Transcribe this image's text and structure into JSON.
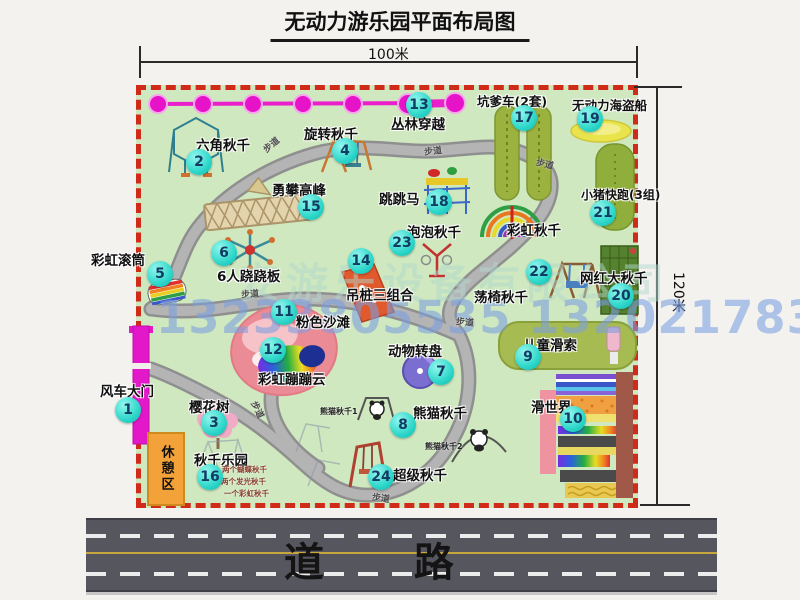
{
  "title": "无动力游乐园平面布局图",
  "dimensions": {
    "width": "100米",
    "height": "120米"
  },
  "road_label": "道 路",
  "rest_area_label": "休憩区",
  "walkway_text": "步道",
  "watermark": {
    "company": "安游乐设备有限公司",
    "phone": "13233805535 13202178333"
  },
  "colors": {
    "park_green": "#cfe8bf",
    "border_red": "#d02b18",
    "badge_cyan": "#2bd6c9",
    "gate_magenta": "#e318c8",
    "rest_orange": "#f2a238",
    "road_gray": "#56565e",
    "path_gray": "#a8a8a8"
  },
  "attractions": [
    {
      "num": "1",
      "label": "风车大门",
      "cx": 128,
      "cy": 410,
      "lx": 100,
      "ly": 380
    },
    {
      "num": "2",
      "label": "六角秋千",
      "cx": 199,
      "cy": 162,
      "lx": 196,
      "ly": 134
    },
    {
      "num": "3",
      "label": "樱花树",
      "cx": 214,
      "cy": 423,
      "lx": 189,
      "ly": 396
    },
    {
      "num": "4",
      "label": "旋转秋千",
      "cx": 345,
      "cy": 151,
      "lx": 304,
      "ly": 123
    },
    {
      "num": "5",
      "label": "彩虹滚筒",
      "cx": 160,
      "cy": 274,
      "lx": 91,
      "ly": 249
    },
    {
      "num": "6",
      "label": "6人跷跷板",
      "cx": 224,
      "cy": 253,
      "lx": 217,
      "ly": 265
    },
    {
      "num": "7",
      "label": "动物转盘",
      "cx": 441,
      "cy": 372,
      "lx": 388,
      "ly": 340
    },
    {
      "num": "8",
      "label": "熊猫秋千",
      "cx": 403,
      "cy": 425,
      "lx": 413,
      "ly": 402
    },
    {
      "num": "9",
      "label": "儿童滑索",
      "cx": 528,
      "cy": 357,
      "lx": 523,
      "ly": 334
    },
    {
      "num": "10",
      "label": "滑世界",
      "cx": 573,
      "cy": 419,
      "lx": 531,
      "ly": 396
    },
    {
      "num": "11",
      "label": "粉色沙滩",
      "cx": 284,
      "cy": 312,
      "lx": 296,
      "ly": 311
    },
    {
      "num": "12",
      "label": "彩虹蹦蹦云",
      "cx": 273,
      "cy": 350,
      "lx": 258,
      "ly": 368
    },
    {
      "num": "13",
      "label": "丛林穿越",
      "cx": 419,
      "cy": 105,
      "lx": 391,
      "ly": 113
    },
    {
      "num": "14",
      "label": "吊桩三组合",
      "cx": 361,
      "cy": 261,
      "lx": 346,
      "ly": 284
    },
    {
      "num": "15",
      "label": "勇攀高峰",
      "cx": 311,
      "cy": 207,
      "lx": 272,
      "ly": 179
    },
    {
      "num": "16",
      "label": "秋千乐园",
      "cx": 210,
      "cy": 477,
      "lx": 194,
      "ly": 449
    },
    {
      "num": "17",
      "label": "坑爹车(2套)",
      "cx": 524,
      "cy": 118,
      "lx": 477,
      "ly": 91,
      "fs": 12.5
    },
    {
      "num": "18",
      "label": "跳跳马",
      "cx": 439,
      "cy": 202,
      "lx": 379,
      "ly": 188
    },
    {
      "num": "19",
      "label": "无动力海盗船",
      "cx": 590,
      "cy": 119,
      "lx": 572,
      "ly": 95,
      "fs": 12.5
    },
    {
      "num": "20",
      "label": "网红大秋千",
      "cx": 621,
      "cy": 296,
      "lx": 580,
      "ly": 267
    },
    {
      "num": "21",
      "label": "小猪快跑(3组)",
      "cx": 603,
      "cy": 213,
      "lx": 581,
      "ly": 186,
      "fs": 12
    },
    {
      "num": "22",
      "label": "荡椅秋千",
      "cx": 539,
      "cy": 272,
      "lx": 474,
      "ly": 286
    },
    {
      "num": "23",
      "label": "泡泡秋千",
      "cx": 402,
      "cy": 243,
      "lx": 407,
      "ly": 221
    },
    {
      "num": "24",
      "label": "超级秋千",
      "cx": 381,
      "cy": 477,
      "lx": 393,
      "ly": 464
    },
    {
      "num": "",
      "label": "彩虹秋千",
      "cx": 0,
      "cy": 0,
      "lx": 507,
      "ly": 219
    }
  ],
  "sub_labels": [
    {
      "text": "熊猫秋千1",
      "x": 320,
      "y": 406,
      "red": false
    },
    {
      "text": "熊猫秋千2",
      "x": 425,
      "y": 441,
      "red": false
    },
    {
      "text": "两个蝴蝶秋千",
      "x": 222,
      "y": 464,
      "red": true
    },
    {
      "text": "两个发光秋千",
      "x": 221,
      "y": 476,
      "red": true
    },
    {
      "text": "一个彩虹秋千",
      "x": 224,
      "y": 488,
      "red": true
    }
  ],
  "walkways": [
    {
      "x": 262,
      "y": 138,
      "r": -40
    },
    {
      "x": 424,
      "y": 144,
      "r": -6
    },
    {
      "x": 536,
      "y": 157,
      "r": 14
    },
    {
      "x": 241,
      "y": 287,
      "r": -4
    },
    {
      "x": 456,
      "y": 315,
      "r": 5
    },
    {
      "x": 249,
      "y": 403,
      "r": 64
    },
    {
      "x": 372,
      "y": 491,
      "r": 8
    }
  ]
}
